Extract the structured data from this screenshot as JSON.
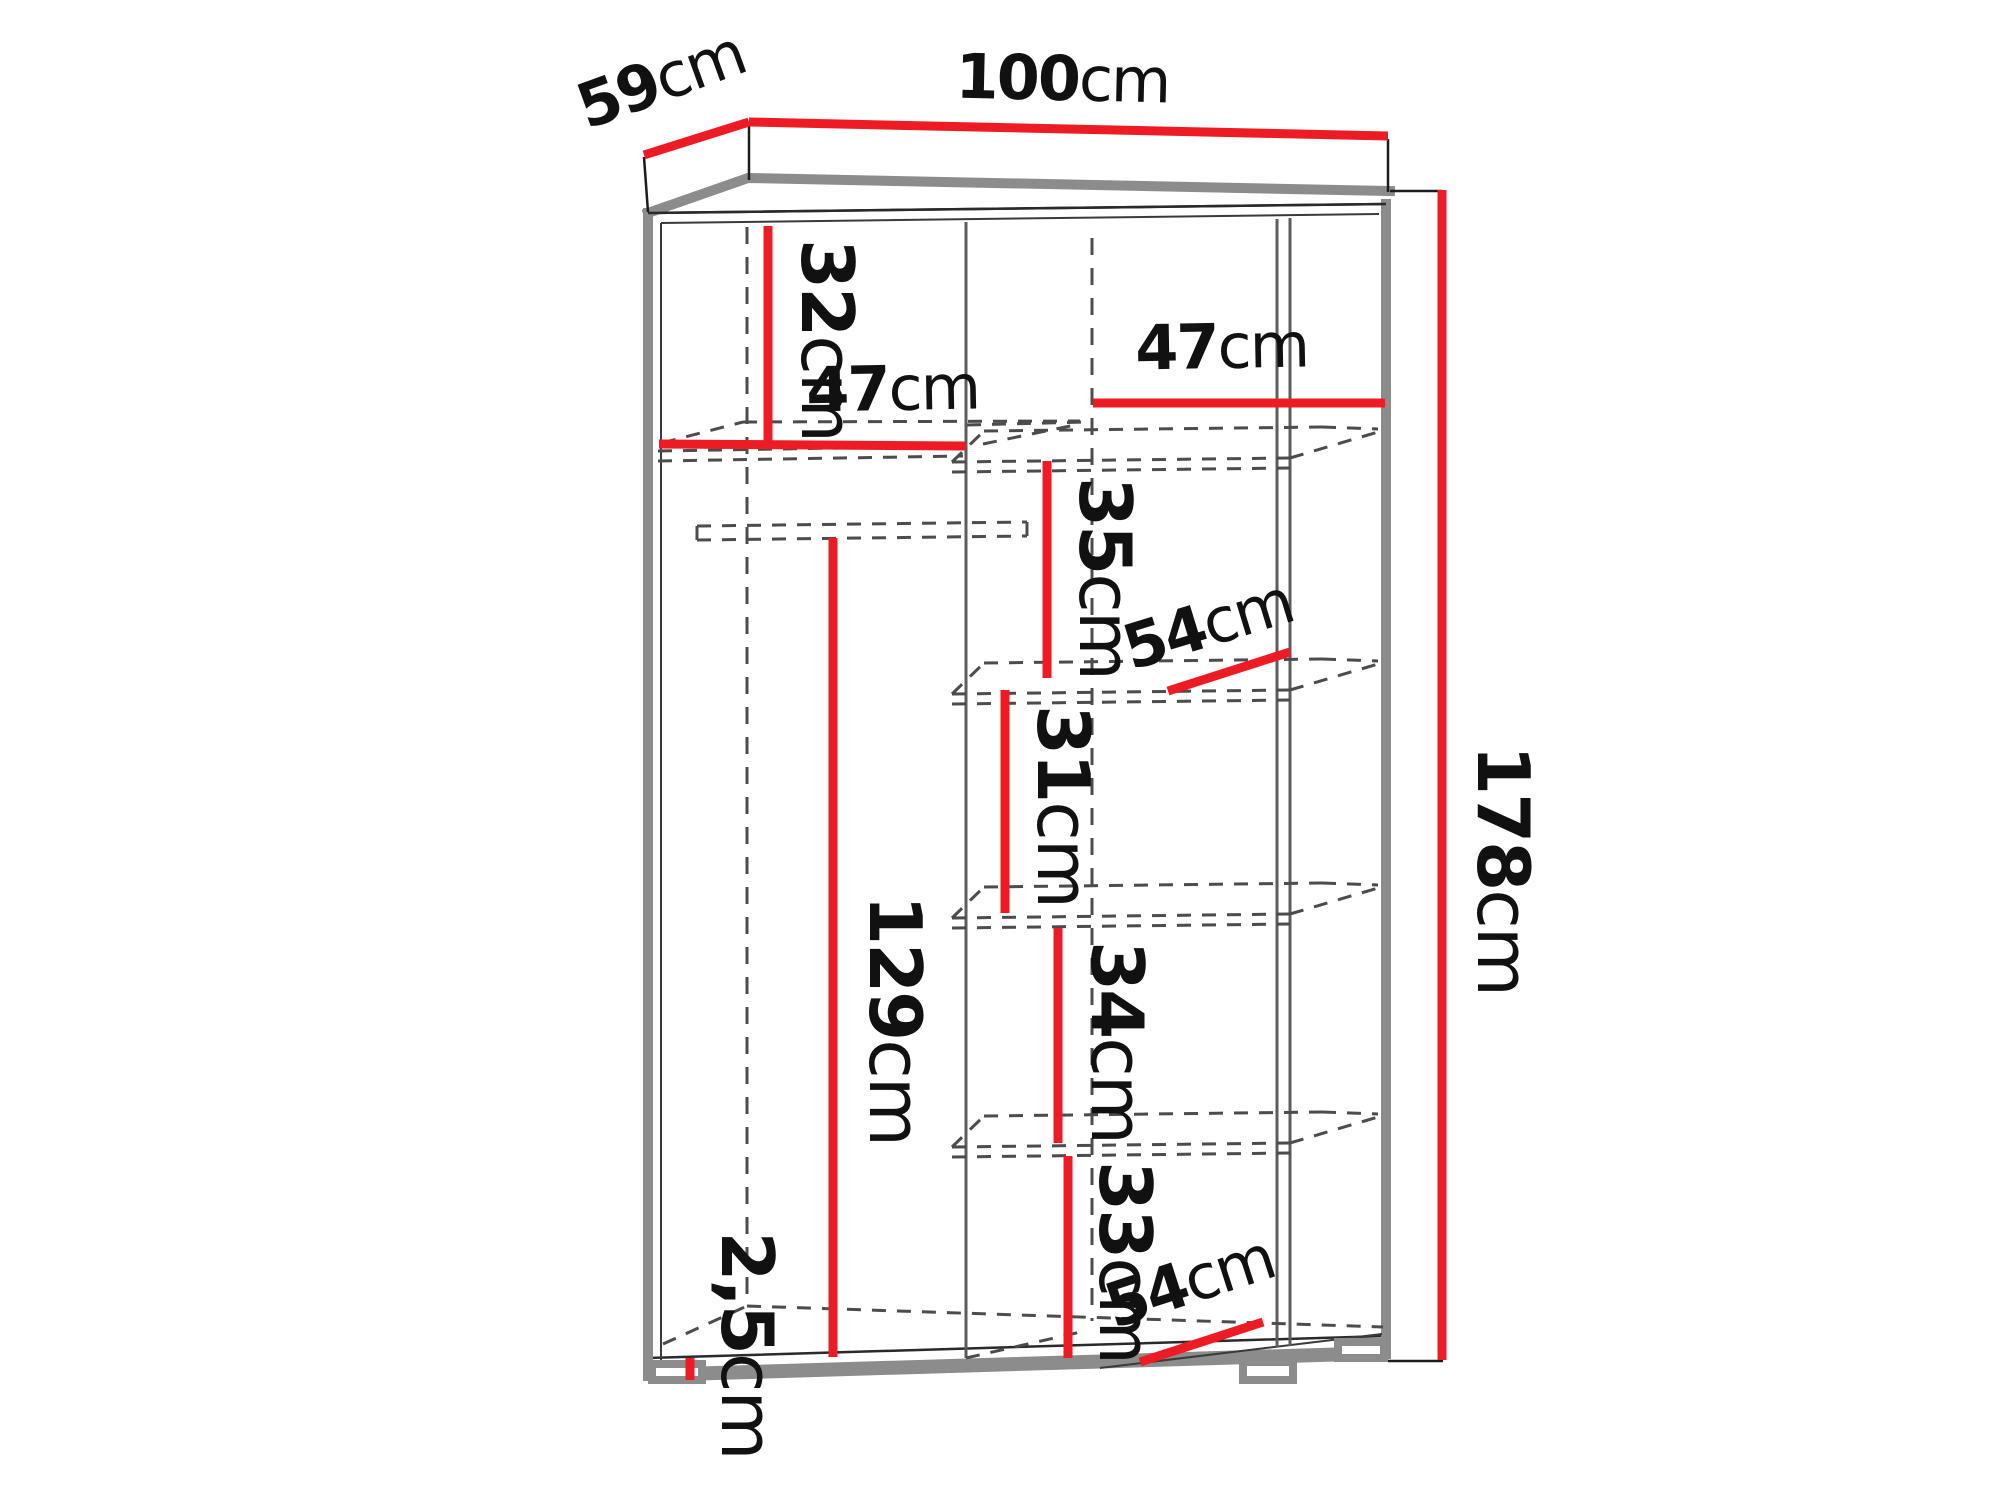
{
  "accent_color": "#ed1c24",
  "edge_color": "#8c8c8c",
  "diagram": {
    "type": "furniture-dimension-diagram",
    "subject": "wardrobe with shelves and hanging rail",
    "unit": "cm"
  },
  "dims": {
    "width": {
      "value": "100",
      "unit": "cm"
    },
    "depth": {
      "value": "59",
      "unit": "cm"
    },
    "height": {
      "value": "178",
      "unit": "cm"
    },
    "top_shelf": {
      "value": "32",
      "unit": "cm"
    },
    "left_bay": {
      "value": "47",
      "unit": "cm"
    },
    "right_bay": {
      "value": "47",
      "unit": "cm"
    },
    "gap_35": {
      "value": "35",
      "unit": "cm"
    },
    "depth_mid": {
      "value": "54",
      "unit": "cm"
    },
    "gap_31": {
      "value": "31",
      "unit": "cm"
    },
    "hanging": {
      "value": "129",
      "unit": "cm"
    },
    "gap_34": {
      "value": "34",
      "unit": "cm"
    },
    "gap_33": {
      "value": "33",
      "unit": "cm"
    },
    "depth_bottom": {
      "value": "54",
      "unit": "cm"
    },
    "plinth": {
      "value": "2,5",
      "unit": "cm"
    }
  }
}
